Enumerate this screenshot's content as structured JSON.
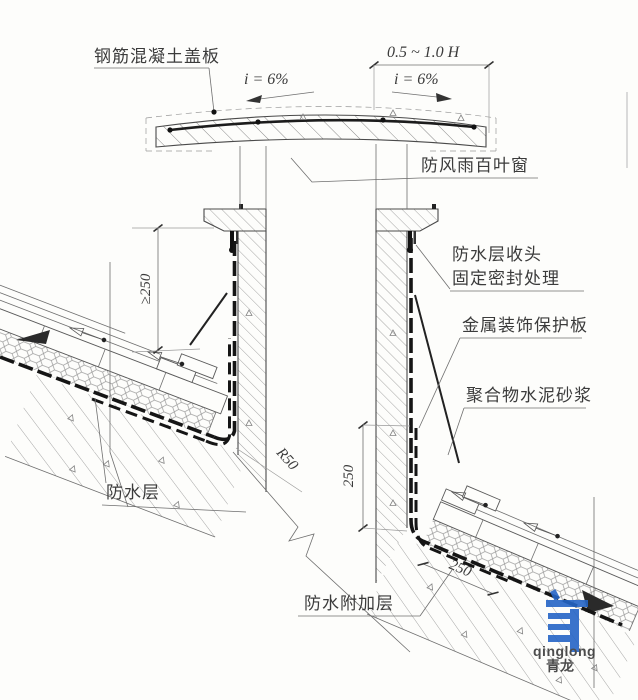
{
  "drawing": {
    "title_hint": "roof ventilation shaft waterproofing construction detail",
    "labels": {
      "cover_slab": "钢筋混凝土盖板",
      "louver": "防风雨百叶窗",
      "head1": "防水层收头",
      "head2": "固定密封处理",
      "metal_plate": "金属装饰保护板",
      "polymer_mortar": "聚合物水泥砂浆",
      "waterproof_layer": "防水层",
      "waterproof_added_layer": "防水附加层"
    },
    "dims": {
      "top_width": "0.5 ~ 1.0 H",
      "slope_left": "i = 6%",
      "slope_right": "i = 6%",
      "min_height": "≥250",
      "wall_height": "250",
      "slope_length": "250",
      "corner_radius": "R50"
    },
    "logo": {
      "latin": "qinglong",
      "cjk": "青龙"
    },
    "colors": {
      "paper": "#fdfdfb",
      "line": "#4a4a4a",
      "hatch": "#8e8e8e",
      "membrane": "#151515",
      "logo_blue": "#2565c6"
    }
  }
}
